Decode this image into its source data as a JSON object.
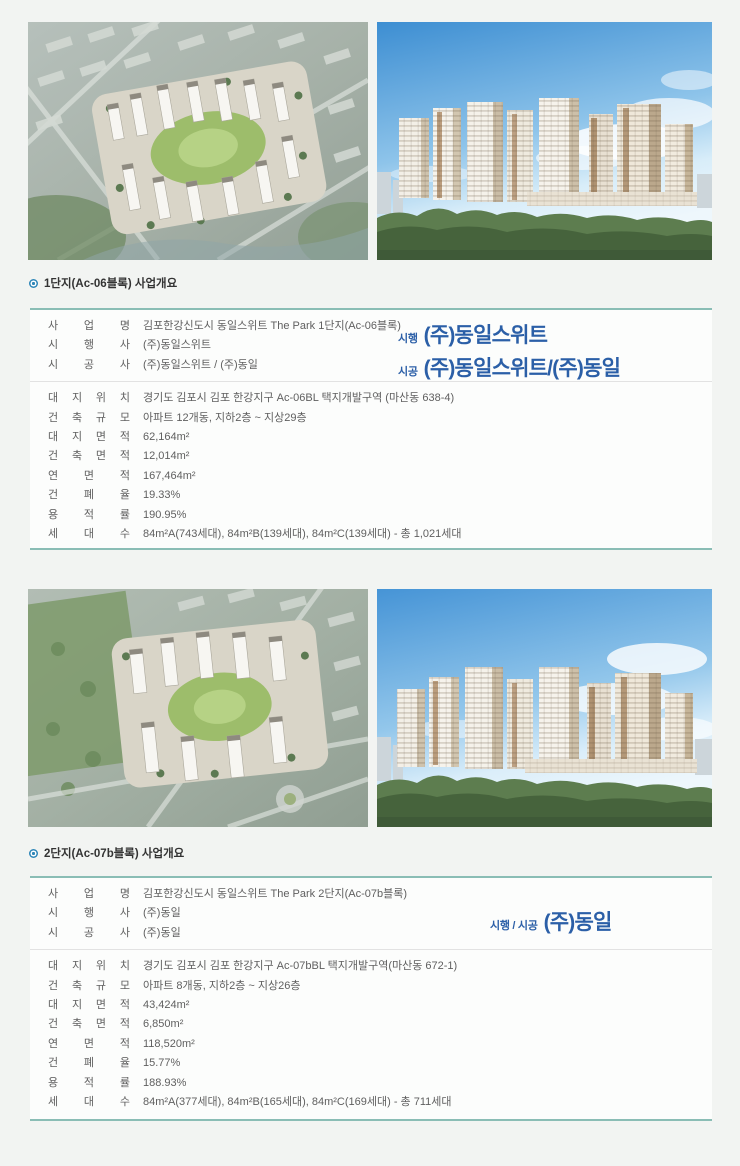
{
  "colors": {
    "page_bg": "#f2f4f2",
    "table_bg": "#fcfdfc",
    "accent_teal_border": "#8abdb5",
    "divider_gray": "#e2e2e2",
    "logo_blue": "#2b5fa7",
    "bullet_blue": "#2e86b8",
    "body_text": "#5f5f5f",
    "title_text": "#333333"
  },
  "icons": {
    "bullet": "blue-ring-dot"
  },
  "images": [
    {
      "name": "aerial-rendering-complex-1"
    },
    {
      "name": "elevation-rendering-complex-1"
    },
    {
      "name": "aerial-rendering-complex-2"
    },
    {
      "name": "elevation-rendering-complex-2"
    }
  ],
  "sections": [
    {
      "title": "1단지(Ac-06블록) 사업개요",
      "logo_lines": [
        {
          "prefix": "시행",
          "name": "(주)동일스위트"
        },
        {
          "prefix": "시공",
          "name": "(주)동일스위트/(주)동일"
        }
      ],
      "rows_top": [
        {
          "label": "사 업 명",
          "value": "김포한강신도시 동일스위트 The Park 1단지(Ac-06블록)"
        },
        {
          "label": "시 행 사",
          "value": "(주)동일스위트"
        },
        {
          "label": "시 공 사",
          "value": "(주)동일스위트 / (주)동일"
        }
      ],
      "rows_bottom": [
        {
          "label": "대 지 위 치",
          "value": "경기도 김포시 김포 한강지구 Ac-06BL 택지개발구역 (마산동 638-4)"
        },
        {
          "label": "건 축 규 모",
          "value": "아파트 12개동, 지하2층 ~ 지상29층"
        },
        {
          "label": "대 지 면 적",
          "value": "62,164m²"
        },
        {
          "label": "건 축 면 적",
          "value": "12,014m²"
        },
        {
          "label": "연 면 적",
          "value": "167,464m²"
        },
        {
          "label": "건 폐 율",
          "value": "19.33%"
        },
        {
          "label": "용 적 률",
          "value": "190.95%"
        },
        {
          "label": "세 대 수",
          "value": "84m²A(743세대), 84m²B(139세대), 84m²C(139세대) - 총 1,021세대"
        }
      ]
    },
    {
      "title": "2단지(Ac-07b블록) 사업개요",
      "logo_lines": [
        {
          "prefix": "시행 / 시공",
          "name": "(주)동일"
        }
      ],
      "rows_top": [
        {
          "label": "사 업 명",
          "value": "김포한강신도시 동일스위트 The Park 2단지(Ac-07b블록)"
        },
        {
          "label": "시 행 사",
          "value": "(주)동일"
        },
        {
          "label": "시 공 사",
          "value": "(주)동일"
        }
      ],
      "rows_bottom": [
        {
          "label": "대 지 위 치",
          "value": "경기도 김포시 김포 한강지구 Ac-07bBL 택지개발구역(마산동 672-1)"
        },
        {
          "label": "건 축 규 모",
          "value": "아파트 8개동, 지하2층 ~ 지상26층"
        },
        {
          "label": "대 지 면 적",
          "value": "43,424m²"
        },
        {
          "label": "건 축 면 적",
          "value": "6,850m²"
        },
        {
          "label": "연 면 적",
          "value": "118,520m²"
        },
        {
          "label": "건 폐 율",
          "value": "15.77%"
        },
        {
          "label": "용 적 률",
          "value": "188.93%"
        },
        {
          "label": "세 대 수",
          "value": "84m²A(377세대), 84m²B(165세대), 84m²C(169세대) - 총 711세대"
        }
      ]
    }
  ]
}
